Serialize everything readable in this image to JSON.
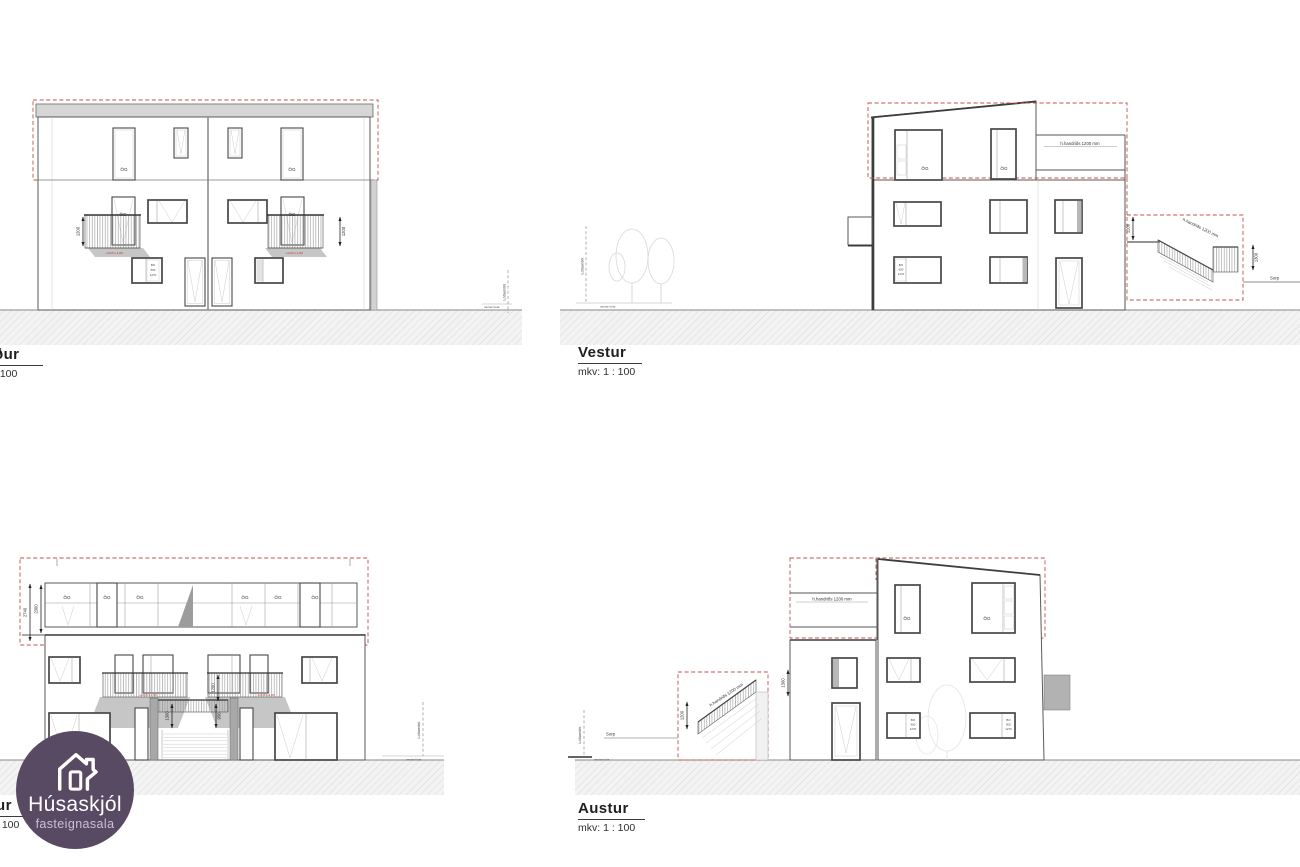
{
  "page": {
    "background": "#ffffff"
  },
  "logo": {
    "title": "Húsaskjól",
    "subtitle": "fasteignasala",
    "bg_color": "#594a64",
    "text_color": "#ffffff",
    "subtitle_color": "#cabfd4",
    "icon": "house-icon"
  },
  "elevations": {
    "top_left": {
      "title_fragment": "ður",
      "scale_fragment": ": 100"
    },
    "vestur": {
      "title": "Vestur",
      "scale": "mkv: 1 : 100"
    },
    "bottom_left": {
      "title_fragment": "ur",
      "scale_fragment": ": 100"
    },
    "austur": {
      "title": "Austur",
      "scale": "mkv: 1 : 100"
    }
  },
  "annotations": {
    "og_label": "ÖG",
    "handrail_note": "h.handriðs 1200 mm",
    "sorp": "Sorp",
    "lot_boundary": "Lóðamörk",
    "missing_note": "vantar kóta",
    "level_note_red": "+10,8=+1,80",
    "window_spec": {
      "l1": "BO",
      "l2": "600",
      "l3": "1270"
    },
    "dims": {
      "d1200": "1200",
      "d1300": "1300",
      "d950": "950",
      "d2740": "2740",
      "d2300": "2300"
    }
  },
  "colors": {
    "red_dashed": "#c0504d",
    "red_text": "#c0392b",
    "roof_band": "#d6d6d6",
    "drawing_line": "#555555",
    "ground_hatch": "#dcdcdc",
    "logo_purple": "#594a64"
  }
}
